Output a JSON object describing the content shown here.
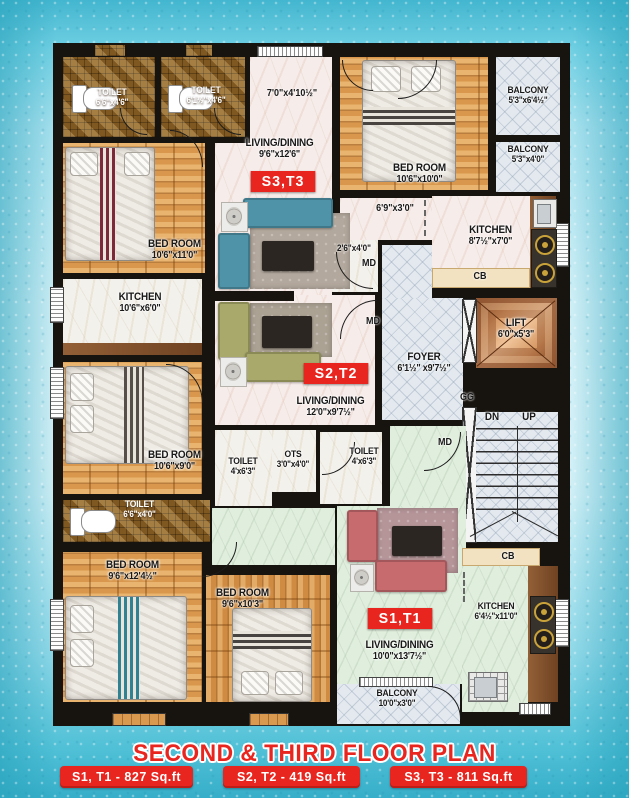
{
  "title": "SECOND & THIRD FLOOR PLAN",
  "footer_badges": [
    "S1, T1 - 827 Sq.ft",
    "S2, T2 - 419 Sq.ft",
    "S3, T3 - 811 Sq.ft"
  ],
  "units": {
    "s1": "S1,T1",
    "s2": "S2,T2",
    "s3": "S3,T3"
  },
  "rooms": {
    "toilet_tl1": {
      "name": "TOILET",
      "dim": "6'6\"x4'6\""
    },
    "toilet_tl2": {
      "name": "TOILET",
      "dim": "6'1½\"x4'6\""
    },
    "bedroom_tl": {
      "name": "BED ROOM",
      "dim": "10'6\"x11'0\""
    },
    "kitchen_ml": {
      "name": "KITCHEN",
      "dim": "10'6\"x6'0\""
    },
    "bedroom_ml": {
      "name": "BED ROOM",
      "dim": "10'6\"x9'0\""
    },
    "toilet_bl": {
      "name": "TOILET",
      "dim": "6'6\"x4'0\""
    },
    "bedroom_bl": {
      "name": "BED ROOM",
      "dim": "9'6\"x12'4½\""
    },
    "bedroom_bm": {
      "name": "BED ROOM",
      "dim": "9'6\"x10'3\""
    },
    "living_s3": {
      "name": "LIVING/DINING",
      "dim": "9'6\"x12'6\""
    },
    "living_s2": {
      "name": "LIVING/DINING",
      "dim": "12'0\"x9'7½\""
    },
    "living_s1": {
      "name": "LIVING/DINING",
      "dim": "10'0\"x13'7½\""
    },
    "bedroom_tr": {
      "name": "BED ROOM",
      "dim": "10'6\"x10'0\""
    },
    "balcony_tr1": {
      "name": "BALCONY",
      "dim": "5'3\"x6'4½\""
    },
    "balcony_tr2": {
      "name": "BALCONY",
      "dim": "5'3\"x4'0\""
    },
    "kitchen_tr": {
      "name": "KITCHEN",
      "dim": "8'7½\"x7'0\""
    },
    "kitchen_br": {
      "name": "KITCHEN",
      "dim": "6'4½\"x11'0\""
    },
    "lift": {
      "name": "LIFT",
      "dim": "6'0\"x5'3\""
    },
    "foyer": {
      "name": "FOYER",
      "dim": "6'1½\" x9'7½\""
    },
    "toilet_m1": {
      "name": "TOILET",
      "dim": "4'x6'3\""
    },
    "toilet_m2": {
      "name": "TOILET",
      "dim": "4'x6'3\""
    },
    "ots": {
      "name": "OTS",
      "dim": "3'0\"x4'0\""
    },
    "balcony_s1": {
      "name": "BALCONY",
      "dim": "10'0\"x3'0\""
    }
  },
  "annotations": {
    "dim_top_lobby": "7'0\"x4'10½\"",
    "dim_kitchen_passage": "6'9\"x3'0\"",
    "dim_md_door": "2'6\"x4'0\"",
    "md": "MD",
    "cb": "CB",
    "gg": "GG",
    "dn": "DN",
    "up": "UP"
  },
  "colors": {
    "accent_red": "#e8251e",
    "wall": "#17130e",
    "wood": "#dfa055",
    "mosaic_brown": "#8f6428",
    "tile_gray": "#e3e9ee",
    "marble_green": "#e0eedd",
    "lift_copper": "#c8824f",
    "cream": "#f2e2c2",
    "background_teal": "#5bc6da"
  }
}
